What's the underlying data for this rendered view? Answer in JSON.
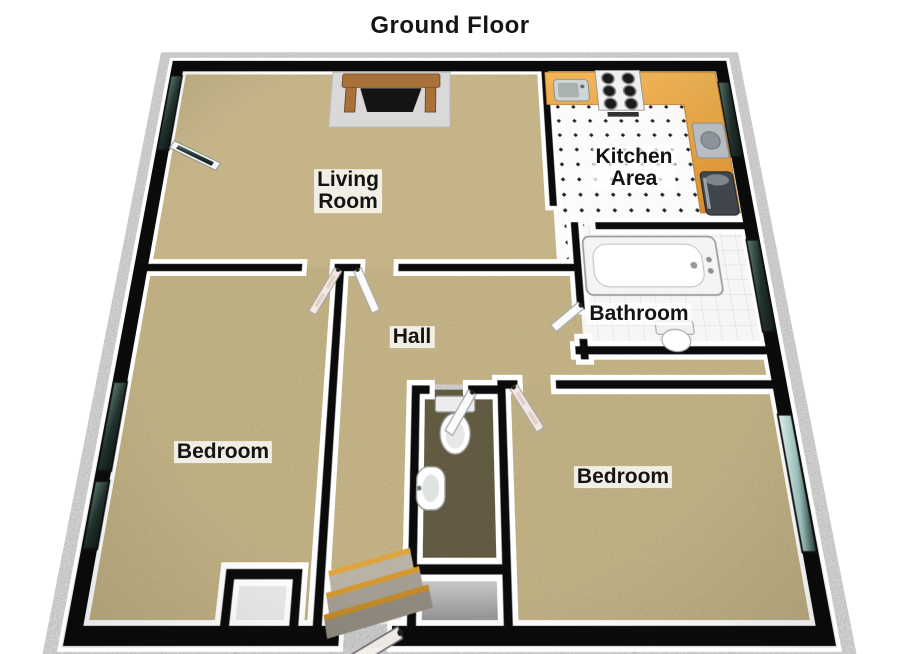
{
  "title": "Ground Floor",
  "floorplan": {
    "rooms": [
      {
        "name": "living-room",
        "label": "Living\nRoom"
      },
      {
        "name": "kitchen-area",
        "label": "Kitchen\nArea"
      },
      {
        "name": "hall",
        "label": "Hall"
      },
      {
        "name": "bathroom",
        "label": "Bathroom"
      },
      {
        "name": "bedroom-left",
        "label": "Bedroom"
      },
      {
        "name": "bedroom-right",
        "label": "Bedroom"
      }
    ],
    "fixtures": [
      "fireplace",
      "stove-hob",
      "kitchen-sink",
      "kitchen-counter",
      "washer",
      "refrigerator",
      "bathtub",
      "bathroom-toilet",
      "wc-toilet",
      "wash-basin",
      "entrance-stairs",
      "front-door",
      "patio-door",
      "interior-doors",
      "windows",
      "closet",
      "landing"
    ],
    "colors": {
      "carpet": "#d7c594",
      "kitchen_counter": "#e49a41",
      "wc_floor": "#6d654a",
      "glass_light": "#d8efeb",
      "glass_dark": "#16211f",
      "wall_cap": "#0b0b0b",
      "wall_face": "#ffffff",
      "tile_white": "#fbfbfb",
      "closet_floor": "#b9b9b9",
      "stair_wood": "#d4982f",
      "label_text": "#141414",
      "label_bg": "#ffffff"
    }
  }
}
